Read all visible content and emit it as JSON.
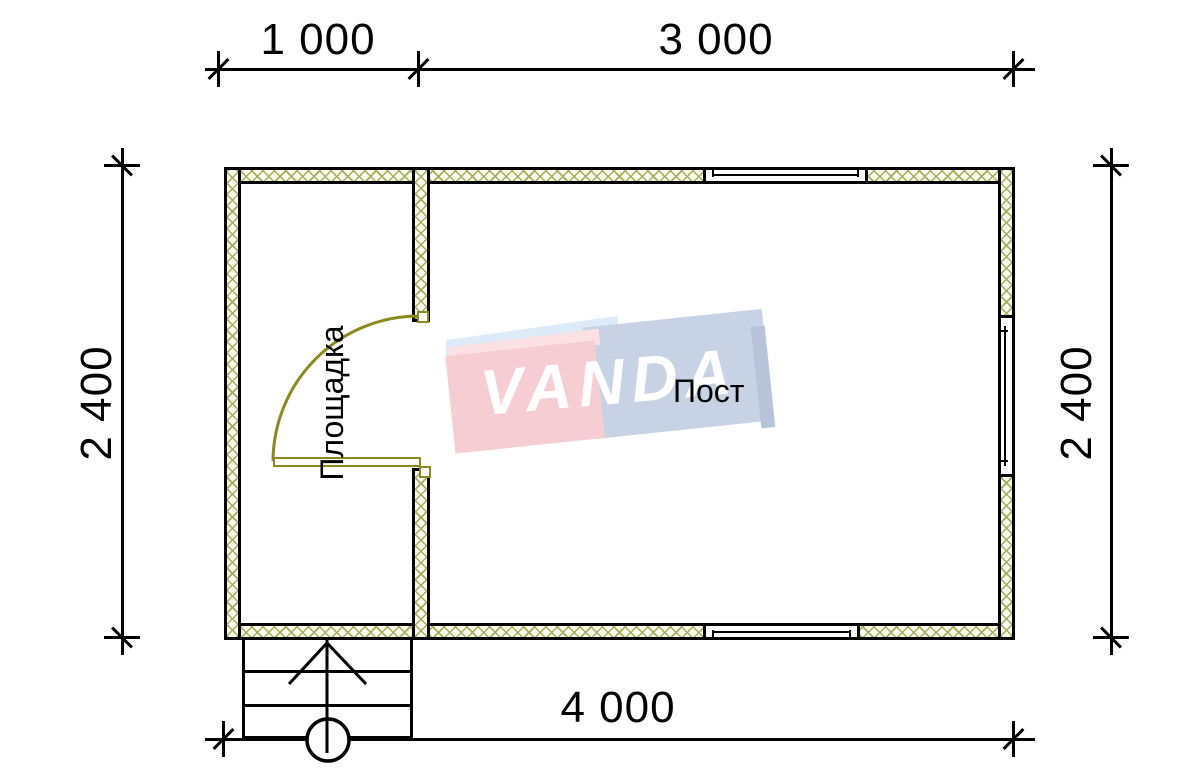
{
  "plan": {
    "rooms": [
      {
        "label": "Площадка"
      },
      {
        "label": "Пост"
      }
    ],
    "dimensions": {
      "top_segments": [
        {
          "label": "1 000"
        },
        {
          "label": "3 000"
        }
      ],
      "left": {
        "label": "2 400"
      },
      "right": {
        "label": "2 400"
      },
      "bottom": {
        "label": "4 000"
      }
    },
    "watermark": {
      "text": "VANDA"
    },
    "colors": {
      "wall_hatch": "#a6ac58",
      "wall_fill": "#fbfbf0",
      "door_color": "#8a8b1c",
      "line_color": "#000000",
      "logo_pink_front": "#f7cdd4",
      "logo_pink_top": "#fbe0e4",
      "logo_blue_front": "#c7d3e4",
      "logo_blue_top": "#dcebf7",
      "logo_blue_side": "#b6c3d8"
    }
  }
}
